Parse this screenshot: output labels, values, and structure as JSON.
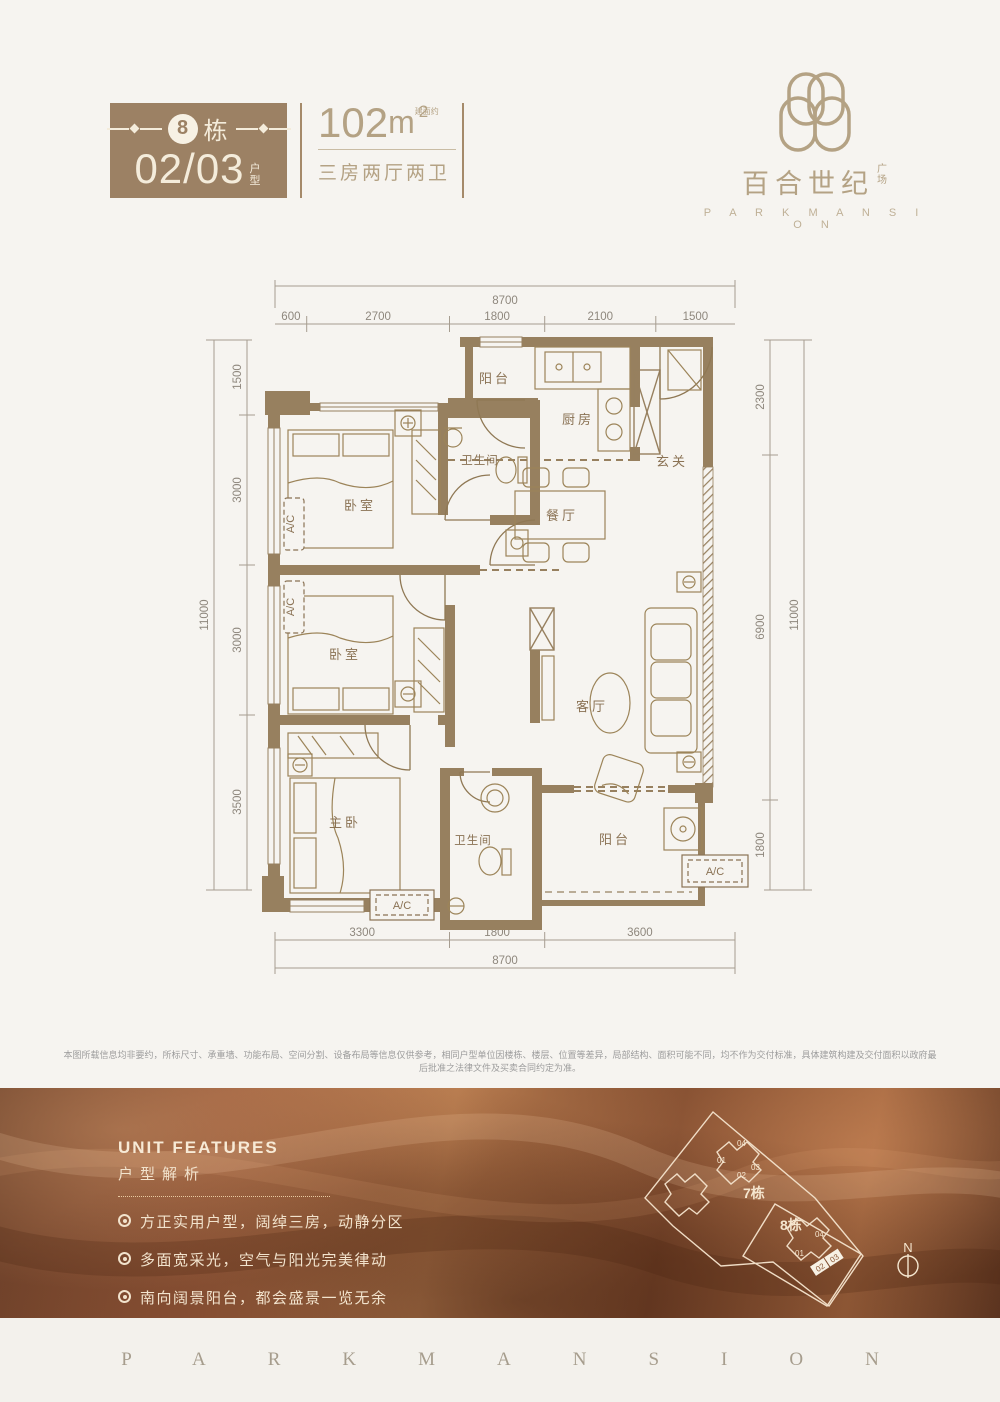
{
  "header": {
    "badge": {
      "num": "8",
      "num_suffix": "栋",
      "unit": "02/03",
      "unit_suffix": "户型"
    },
    "area": {
      "value": "102",
      "unit": "m",
      "note": "建面约",
      "exp": "2",
      "layout": "三房两厅两卫"
    },
    "logo": {
      "cn": "百合世纪",
      "cn_suffix": "广场",
      "en": "P A R K M A N S I O N"
    }
  },
  "floorplan": {
    "dims": {
      "top_total": "8700",
      "top_segments": [
        "600",
        "2700",
        "1800",
        "2100",
        "1500"
      ],
      "bottom_segments": [
        "3300",
        "1800",
        "3600"
      ],
      "bottom_total": "8700",
      "left_total": "11000",
      "left_segments": [
        "1500",
        "3000",
        "3000",
        "3500"
      ],
      "right_segments": [
        "2300",
        "6900",
        "1800"
      ],
      "right_total": "11000"
    },
    "rooms": {
      "balcony_top": "阳台",
      "kitchen": "厨房",
      "foyer": "玄关",
      "bath_top": "卫生间",
      "bedroom_top": "卧室",
      "dining": "餐厅",
      "bedroom_mid": "卧室",
      "living": "客厅",
      "master": "主卧",
      "bath_bottom": "卫生间",
      "balcony_bottom": "阳台",
      "ac": "A/C"
    }
  },
  "disclaimer": "本图所载信息均非要约，所标尺寸、承重墙、功能布局、空间分割、设备布局等信息仅供参考，相同户型单位因楼栋、楼层、位置等差异，局部结构、面积可能不同，均不作为交付标准，具体建筑构建及交付面积以政府最后批准之法律文件及买卖合同约定为准。",
  "features": {
    "title_en": "UNIT FEATURES",
    "title_cn": "户型解析",
    "items": [
      "方正实用户型，阔绰三房，动静分区",
      "多面宽采光，空气与阳光完美律动",
      "南向阔景阳台，都会盛景一览无余",
      "主卧套间，独立卫浴，私享专属品质空间"
    ]
  },
  "siteplan": {
    "building7": "7栋",
    "building8": "8栋",
    "units7": [
      "01",
      "04",
      "02",
      "03"
    ],
    "units8": [
      "01",
      "04",
      "02",
      "03"
    ],
    "north": "N"
  },
  "footer": {
    "brand": "PARKMANSION"
  },
  "colors": {
    "badge_brown": "#9c8164",
    "gold": "#b4a284",
    "wall": "#97805f",
    "band_brown": "#8a5634"
  }
}
